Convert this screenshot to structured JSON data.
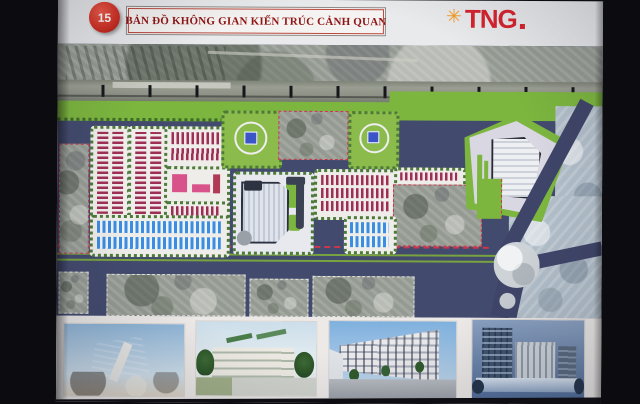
{
  "slide": {
    "number": "15",
    "title": "BẢN ĐỒ KHÔNG GIAN KIẾN TRÚC CẢNH QUAN",
    "logo": {
      "text": "TNG",
      "symbol_glyph": "✳",
      "text_color": "#d6232e",
      "symbol_color": "#f59b22"
    }
  },
  "map": {
    "kind": "master-plan-site-map",
    "features": [
      "satellite-railway-corridor-top",
      "green-buffer-strip",
      "red-rowhouse-blocks",
      "blue-rowhouse-blocks",
      "kindergarten-pink-block",
      "central-school-plot",
      "two-parks-with-blue-plaza",
      "retained-existing-parcels-red-dashed",
      "triangular-commercial-plot",
      "diagonal-road",
      "roundabout",
      "main-boulevard-with-green-medians",
      "existing-village-bottom-band",
      "existing-area-bottom-right"
    ],
    "colors": {
      "road": "#424a6e",
      "greenery": "#7cb63e",
      "rowhouse_red": "#9c3054",
      "rowhouse_blue": "#3c8ce0",
      "boundary_dash": "#c8374b",
      "plaza_blue": "#3b55c8"
    }
  },
  "gallery": {
    "items": [
      {
        "label": "render-cultural-center"
      },
      {
        "label": "render-lowrise-school"
      },
      {
        "label": "render-shophouse-street"
      },
      {
        "label": "render-commercial-complex"
      }
    ]
  }
}
